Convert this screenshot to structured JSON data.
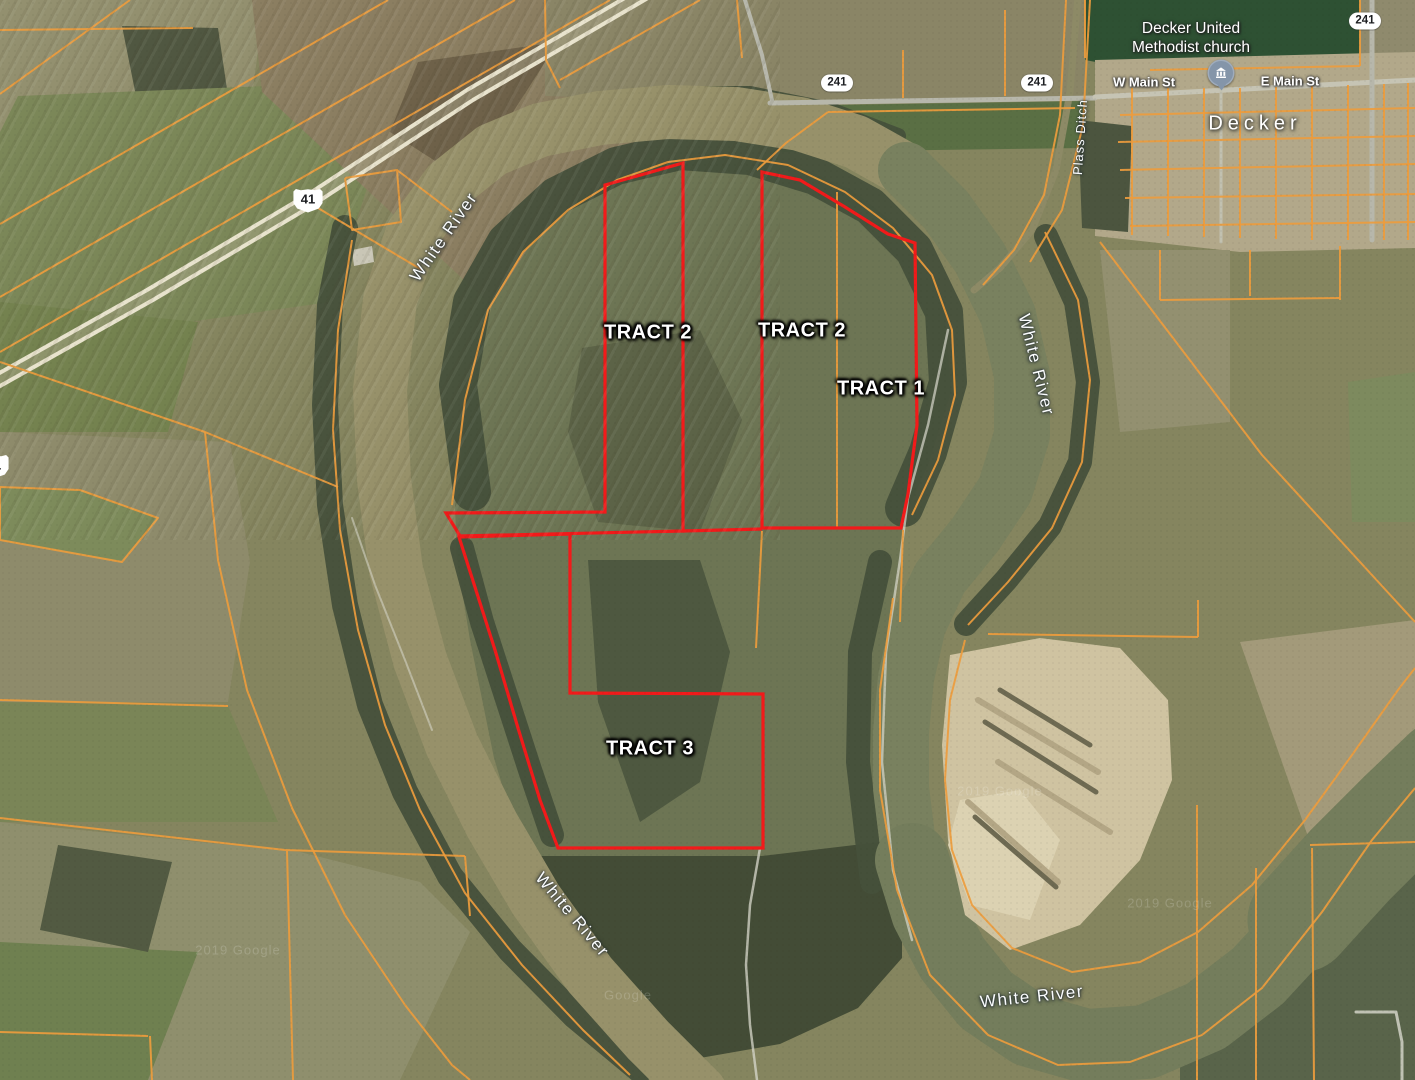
{
  "canvas": {
    "w": 1415,
    "h": 1080
  },
  "palette": {
    "base": "#85855F",
    "parcel": "#ED9C3D",
    "tract_red": "#F21A1A",
    "road": "#B7B7AB",
    "road_pale": "#E8E3CD",
    "water_tan": "#97916A",
    "water_green": "#79815F",
    "forest": "#46503B",
    "sand": "#CFC3A1"
  },
  "labels": {
    "rivers": [
      {
        "text": "White River",
        "x": 444,
        "y": 237,
        "r": -55
      },
      {
        "text": "White River",
        "x": 1036,
        "y": 365,
        "r": 76
      },
      {
        "text": "White River",
        "x": 572,
        "y": 915,
        "r": 50
      },
      {
        "text": "White River",
        "x": 1032,
        "y": 997,
        "r": -6
      }
    ],
    "ditch": {
      "text": "Plass Ditch",
      "x": 1080,
      "y": 137,
      "r": -86
    },
    "tracts": [
      {
        "text": "TRACT 2",
        "x": 648,
        "y": 333,
        "r": 0
      },
      {
        "text": "TRACT 2",
        "x": 802,
        "y": 331,
        "r": 0
      },
      {
        "text": "TRACT 1",
        "x": 881,
        "y": 389,
        "r": 0
      },
      {
        "text": "TRACT 3",
        "x": 650,
        "y": 749,
        "r": 0
      }
    ],
    "streets": [
      {
        "text": "W Main St",
        "x": 1144,
        "y": 82,
        "r": 0
      },
      {
        "text": "E Main St",
        "x": 1290,
        "y": 81,
        "r": 0
      }
    ],
    "town": {
      "text": "Decker",
      "x": 1255,
      "y": 124,
      "r": 0
    },
    "poi": {
      "line1": "Decker United",
      "line2": "Methodist church",
      "x": 1191,
      "y": 39,
      "r": 0
    },
    "poi_pin": {
      "x": 1221,
      "y": 73,
      "r": 0
    },
    "shields_oval": [
      {
        "text": "241",
        "x": 837,
        "y": 83,
        "r": 0
      },
      {
        "text": "241",
        "x": 1037,
        "y": 83,
        "r": 0
      },
      {
        "text": "241",
        "x": 1365,
        "y": 21,
        "r": 0
      }
    ],
    "shields_us": [
      {
        "text": "41",
        "x": 308,
        "y": 200,
        "r": 0
      },
      {
        "text": "41",
        "x": -6,
        "y": 466,
        "r": 0
      }
    ],
    "watermarks": [
      {
        "text": "2019 Google",
        "x": 238,
        "y": 950,
        "r": 0
      },
      {
        "text": "Google",
        "x": 628,
        "y": 995,
        "r": 0
      },
      {
        "text": "2019 Google",
        "x": 1000,
        "y": 791,
        "r": 0
      },
      {
        "text": "2019 Google",
        "x": 1170,
        "y": 903,
        "r": 0
      }
    ]
  },
  "geometry": {
    "terrain": [
      {
        "name": "tl-gray-field",
        "fill": "#93906F",
        "pts": "0,0 265,0 252,95 118,122 0,132"
      },
      {
        "name": "tl-woods",
        "fill": "#505741",
        "pts": "122,26 218,28 228,96 138,106"
      },
      {
        "name": "tl-green-field",
        "fill": "#7B8758",
        "pts": "18,96 268,86 382,142 330,302 118,332 0,302 0,132"
      },
      {
        "name": "tl-brown-strips",
        "fill": "#8B7E61",
        "pts": "252,0 700,0 760,62 640,160 520,332 380,202 262,92"
      },
      {
        "name": "tl-dark-till",
        "fill": "#6E6149",
        "pts": "418,62 558,42 468,182 390,132"
      },
      {
        "name": "tl-green-low",
        "fill": "#74824F",
        "pts": "0,302 198,322 168,432 0,432"
      },
      {
        "name": "ml-field",
        "fill": "#8E8B6B",
        "pts": "0,432 230,442 250,562 228,702 0,702"
      },
      {
        "name": "ml-green",
        "fill": "#7A8557",
        "pts": "0,702 228,706 278,822 0,822"
      },
      {
        "name": "ml-pentagon",
        "fill": "#7D8B5B",
        "pts": "0,487 80,490 158,518 120,562 0,540"
      },
      {
        "name": "bl-field",
        "fill": "#8F8F6D",
        "pts": "0,822 300,852 420,882 470,932 400,1080 0,1080"
      },
      {
        "name": "bl-green",
        "fill": "#6F8050",
        "pts": "0,942 198,952 148,1080 0,1080"
      },
      {
        "name": "bl-woods",
        "fill": "#525A42",
        "pts": "58,845 172,862 148,952 40,930"
      },
      {
        "name": "tc-field",
        "fill": "#8A8566",
        "pts": "545,0 1085,0 1085,96 770,102 545,96"
      },
      {
        "name": "tc-green-strip",
        "fill": "#5A6F44",
        "pts": "772,106 1085,101 1085,148 782,152"
      },
      {
        "name": "tr-darkgreen-field",
        "fill": "#2E5133",
        "pts": "1085,0 1360,0 1360,68 1150,72 1085,60"
      },
      {
        "name": "tr-strip",
        "fill": "#8F8A6D",
        "pts": "1360,0 1415,0 1415,56 1360,56"
      },
      {
        "name": "town-block",
        "fill": "#B2A88A",
        "pts": "1095,60 1415,52 1415,248 1240,252 1095,236"
      },
      {
        "name": "tr-woods",
        "fill": "#4C553F",
        "pts": "1078,120 1132,126 1128,232 1082,228"
      },
      {
        "name": "peninsula",
        "fill": "#6D7554",
        "pts": "455,505 468,398 492,305 532,242 585,196 645,166 715,153 790,163 852,190 908,234 944,300 951,392 928,465 903,520 900,560 886,652 882,760 897,868 858,958 798,1012 718,1040 648,1000 584,948 540,888 518,838 494,758 470,640 457,560"
      },
      {
        "name": "pen-scrub-a",
        "fill": "#5C6347",
        "pts": "582,348 700,330 742,420 700,532 598,522 568,432"
      },
      {
        "name": "pen-scrub-b",
        "fill": "#4E5840",
        "pts": "588,560 700,560 730,652 700,782 640,822 598,702"
      },
      {
        "name": "pen-south-woods",
        "fill": "#434C36",
        "pts": "540,856 762,856 880,842 902,902 902,958 858,1008 780,1044 700,1058 640,1038 580,988 545,920"
      },
      {
        "name": "rm-field-a",
        "fill": "#A39A7A",
        "pts": "1240,642 1415,620 1415,845 1312,848"
      },
      {
        "name": "rm-field-b",
        "fill": "#939070",
        "pts": "1100,250 1230,250 1230,422 1120,432"
      },
      {
        "name": "rm-green",
        "fill": "#7D8A5E",
        "pts": "1348,382 1415,372 1415,522 1352,522"
      },
      {
        "name": "br-field",
        "fill": "#59644A",
        "pts": "1180,1022 1290,976 1360,902 1415,836 1415,1080 1180,1080"
      },
      {
        "name": "farm-bldg-a",
        "fill": "#C9C6B6",
        "pts": "352,250 372,246 374,262 354,266"
      },
      {
        "name": "farm-bldg-b",
        "fill": "#BDBAA9",
        "pts": "374,262 392,258 394,272 376,276"
      }
    ],
    "forests": [
      {
        "pts": "345,228 330,305 325,405 330,505 345,605 370,705 405,792 450,876 510,950 575,1016 640,1070",
        "w": 26
      },
      {
        "pts": "472,492 458,385 472,302 506,242 556,196 616,166 680,151 750,156 815,176 870,206 914,250 944,312 948,382 928,452 904,508",
        "w": 38
      },
      {
        "pts": "462,548 482,622 506,696 530,770 552,835",
        "w": 24
      },
      {
        "pts": "880,562 860,652 858,762 872,882",
        "w": 24
      },
      {
        "pts": "1046,236 1076,302 1088,382 1080,462 1050,526 1006,580 966,624",
        "w": 24
      },
      {
        "pts": "542,140 602,112 670,94 750,94 830,110 898,136",
        "w": 16
      }
    ],
    "water": [
      {
        "name": "river-west",
        "color": "#97916A",
        "w": 54,
        "pts": "700,1092 648,1040 590,975 536,900 492,825 452,745 420,660 396,570 384,480 380,390 390,300 412,235 448,185 492,150 540,130 600,118 668,112 736,114 800,124 856,142 906,170"
      },
      {
        "name": "river-east",
        "color": "#79815F",
        "w": 56,
        "pts": "906,170 946,210 980,258 1008,315 1022,375 1022,435 1005,490 975,535 940,578 918,625 906,678 901,732 901,788 908,845 922,900 945,950 980,995 1028,1028 1085,1045 1145,1042 1205,1018 1258,978 1305,925 1348,868 1388,815 1428,775"
      },
      {
        "name": "river-bend-wide",
        "color": "#747D5C",
        "w": 74,
        "pts": "912,860 928,912 952,958 986,1000 1030,1030 1086,1046 1146,1042 1206,1016 1258,976 1306,924 1350,866 1392,812 1430,772"
      },
      {
        "name": "river-mouth",
        "color": "#747D5C",
        "w": 105,
        "pts": "1300,920 1350,865 1400,815 1445,772"
      },
      {
        "name": "plass-ditch-water",
        "color": "#8D8A66",
        "w": 7,
        "pts": "1078,-4 1070,92 1056,170 1032,230 1000,268 974,290"
      }
    ],
    "sand": {
      "outline": "950,655 1040,638 1120,648 1168,700 1172,780 1140,860 1080,925 1010,950 965,915 948,840 942,745",
      "bright": "960,800 1020,790 1060,840 1030,920 970,905 948,845",
      "streaks_light": [
        "978,700 1098,772",
        "998,762 1110,832",
        "968,802 1058,882"
      ],
      "streaks_dark": [
        "985,722 1096,792",
        "975,817 1056,887",
        "1000,690 1090,745"
      ]
    },
    "roads": [
      {
        "pts": "650,-10 470,95 310,200 150,295 -10,385",
        "w": 14,
        "c": "#B0AB8D",
        "op": 0.45
      },
      {
        "pts": "653,-5 473,100 313,205 153,300 -7,390",
        "w": 4,
        "c": "#E8E3CD",
        "op": 1
      },
      {
        "pts": "647,-15 467,90 307,195 147,290 -13,380",
        "w": 4,
        "c": "#E8E3CD",
        "op": 1
      },
      {
        "pts": "770,103 1095,98",
        "w": 5,
        "c": "#B7B7AB",
        "op": 1
      },
      {
        "pts": "1095,97 1415,80",
        "w": 5,
        "c": "#C6C4B4",
        "op": 1
      },
      {
        "pts": "745,0 762,55 772,100",
        "w": 4,
        "c": "#B7B7AB",
        "op": 1
      },
      {
        "pts": "1372,0 1372,240",
        "w": 5,
        "c": "#B7B7AB",
        "op": 1
      },
      {
        "pts": "1221,88 1221,242",
        "w": 3,
        "c": "#C2C1B0",
        "op": 1
      },
      {
        "pts": "948,330 928,425 908,498 900,560 886,652 882,762 893,870 912,940",
        "w": 2.5,
        "c": "#D8D8CC",
        "op": 0.7
      },
      {
        "pts": "760,848 750,905 746,965 750,1025 757,1080",
        "w": 2.5,
        "c": "#D8D8CC",
        "op": 0.75
      },
      {
        "pts": "1356,1012 1396,1012 1402,1042 1402,1080",
        "w": 3,
        "c": "#DADACE",
        "op": 0.8
      },
      {
        "pts": "352,518 375,585 405,660 432,730",
        "w": 2,
        "c": "#D8D8CC",
        "op": 0.55
      }
    ],
    "parcels": [
      "388,0 0,224",
      "515,0 0,297",
      "610,0 0,352",
      "700,0 560,80",
      "130,0 0,94",
      "0,30 193,28",
      "318,208 422,270",
      "345,178 397,170 401,222 352,230 345,178",
      "397,170 452,212",
      "0,487 80,490 158,518 122,562 0,540 0,487",
      "0,362 205,432 338,487",
      "205,432 218,560 247,690 292,808 345,915 405,1005 452,1065 470,1080",
      "352,240 338,330 333,430 340,530 358,630 385,725 420,810 465,893 522,965 583,1030 630,1075",
      "452,505 465,400 488,310 523,252 568,210 617,180 668,162 725,155 788,165 845,192 893,228 932,275 952,330 955,395 938,460 912,515",
      "828,112 1075,108",
      "828,112 786,143 757,170",
      "903,50 903,98",
      "1005,10 1005,96",
      "1066,0 1060,115 1044,195 1014,250 983,285",
      "1090,0 1083,125 1062,210 1030,262",
      "1045,232 1078,300 1090,380 1082,462 1052,528 1008,582 968,625",
      "988,634 1198,637",
      "1198,600 1198,637",
      "965,640 950,700 945,780 952,850 972,905 1012,948 1072,972 1140,962 1198,932 1252,885 1305,820 1352,755 1398,690 1415,668",
      "893,598 880,690 880,790 897,890 930,975 988,1035 1058,1065 1130,1062 1202,1035 1262,988 1322,912 1372,840 1415,788",
      "1197,805 1197,1080",
      "1256,868 1256,1080",
      "1312,848 1314,1080",
      "1310,845 1415,842",
      "1100,242 1262,455 1415,622",
      "1132,88 1132,235",
      "1168,88 1168,236",
      "1204,88 1204,237",
      "1240,88 1240,238",
      "1276,87 1276,239",
      "1312,86 1312,240",
      "1348,85 1348,240",
      "1384,84 1384,240",
      "1408,83 1408,240",
      "1120,115 1415,108",
      "1118,142 1415,136",
      "1120,170 1415,164",
      "1125,198 1415,194",
      "1130,226 1415,222",
      "1160,250 1160,300",
      "1250,250 1250,296",
      "1340,246 1340,300",
      "1160,300 1340,298",
      "1085,0 1085,58",
      "1150,70 1360,66",
      "1360,0 1360,66",
      "837,192 837,528",
      "903,530 900,622",
      "762,531 756,648",
      "0,818 285,850",
      "285,850 465,856",
      "287,851 293,1080",
      "465,856 470,916",
      "0,1032 148,1036",
      "150,1036 152,1080",
      "0,700 228,706",
      "545,0 546,60 560,88",
      "737,0 742,58"
    ],
    "tracts": [
      {
        "name": "tract-2-west-outline",
        "closed": true,
        "pts": "605,185 683,163 683,531 460,536 446,513 605,512"
      },
      {
        "name": "tract-1-2-east-outline",
        "closed": true,
        "pts": "762,528 762,172 800,180 845,207 888,234 915,243 917,425 908,494 901,528"
      },
      {
        "name": "tract-3-outline",
        "closed": true,
        "pts": "459,537 570,534 570,693 763,694 763,848 558,848 540,800 518,728 495,650 474,584"
      },
      {
        "name": "tract-boundary-connector",
        "closed": false,
        "pts": "683,531 762,529"
      }
    ]
  }
}
